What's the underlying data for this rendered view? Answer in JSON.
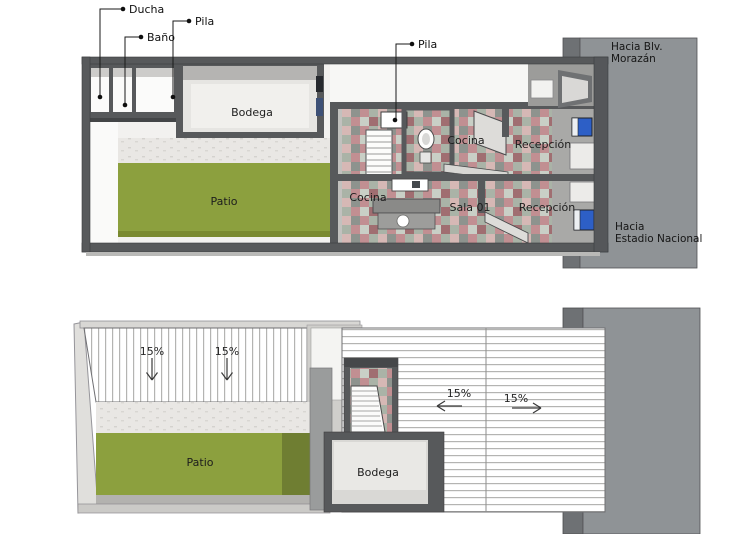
{
  "document": {
    "type": "architectural-plan",
    "background": "#ffffff"
  },
  "colors": {
    "patio_green": "#8ca03e",
    "patio_shadow": "#6f7e32",
    "road_gray": "#8f9396",
    "road_edge_dark": "#6e7174",
    "wall_dark": "#57595b",
    "window_blue": "#2d5fc6",
    "tile_pink": "#c18f92",
    "tile_dark_red": "#a06e71",
    "tile_sage": "#aab3a7",
    "floor_light": "#f2f1ef"
  },
  "upper_plan": {
    "name": "Planta primer nivel",
    "callouts": [
      {
        "id": "ducha",
        "label": "Ducha"
      },
      {
        "id": "pila_left",
        "label": "Pila"
      },
      {
        "id": "bano",
        "label": "Baño"
      },
      {
        "id": "pila_center",
        "label": "Pila"
      }
    ],
    "rooms": [
      {
        "id": "bodega",
        "label": "Bodega"
      },
      {
        "id": "patio",
        "label": "Patio"
      },
      {
        "id": "cocina_upper",
        "label": "Cocina"
      },
      {
        "id": "recepcion_upper",
        "label": "Recepción"
      },
      {
        "id": "cocina_lower",
        "label": "Cocina"
      },
      {
        "id": "sala_01",
        "label": "Sala 01"
      },
      {
        "id": "recepcion_lower",
        "label": "Recepción"
      }
    ]
  },
  "lower_plan": {
    "name": "Planta de techos",
    "rooms": [
      {
        "id": "patio",
        "label": "Patio"
      },
      {
        "id": "bodega",
        "label": "Bodega"
      }
    ],
    "slopes": [
      {
        "id": "roof_left_a",
        "label": "15%",
        "direction": "down"
      },
      {
        "id": "roof_left_b",
        "label": "15%",
        "direction": "down"
      },
      {
        "id": "roof_right_west",
        "label": "15%",
        "direction": "left"
      },
      {
        "id": "roof_right_east",
        "label": "15%",
        "direction": "right"
      }
    ]
  },
  "streets": {
    "north": {
      "line1": "Hacia Blv.",
      "line2": "Morazán"
    },
    "south": {
      "line1": "Hacia",
      "line2": "Estadio Nacional"
    }
  }
}
